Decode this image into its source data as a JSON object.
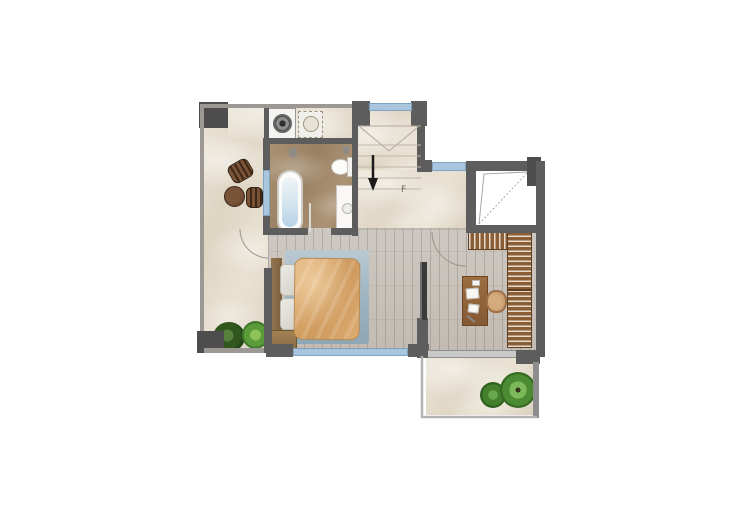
{
  "scene": {
    "type": "residential-floor-plan",
    "view": "top-down-render"
  },
  "stairs": {
    "label": "F",
    "direction_arrow": "down"
  },
  "rooms": [
    {
      "name": "hallway",
      "floor": "beige marble"
    },
    {
      "name": "laundry-nook",
      "floor": "beige marble"
    },
    {
      "name": "bathroom",
      "floor": "brown marble"
    },
    {
      "name": "staircase",
      "floor": "beige marble"
    },
    {
      "name": "bedroom",
      "floor": "grey wood planks"
    },
    {
      "name": "study",
      "floor": "grey wood planks"
    },
    {
      "name": "terrace",
      "floor": "beige marble"
    },
    {
      "name": "void-open-below",
      "floor": "none"
    }
  ],
  "furniture": [
    "washing-machine",
    "laundry-sink",
    "bathtub",
    "toilet",
    "vanity-sink",
    "round-side-table",
    "stool",
    "stool",
    "double-bed",
    "pillows",
    "area-rug",
    "bedside-bench",
    "sliding-door-panel",
    "slatted-wardrobe",
    "desk",
    "desk-chair",
    "potted-plant",
    "potted-plant",
    "terrace-plant",
    "terrace-palm"
  ],
  "windows_count": 4,
  "colors": {
    "wall": "#5d5d5d",
    "wall_corner": "#4d4d4d",
    "window_glass": "#a9c6de",
    "marble_floor": "#e5ddcd",
    "bathroom_floor": "#a18a6c",
    "wood_floor": "#c7c1ba",
    "duvet": "#d7a468",
    "rug": "#a2b8c6",
    "wardrobe_wood": "#8a5f38",
    "plant_green": "#4d8a34",
    "background": "#ffffff"
  }
}
